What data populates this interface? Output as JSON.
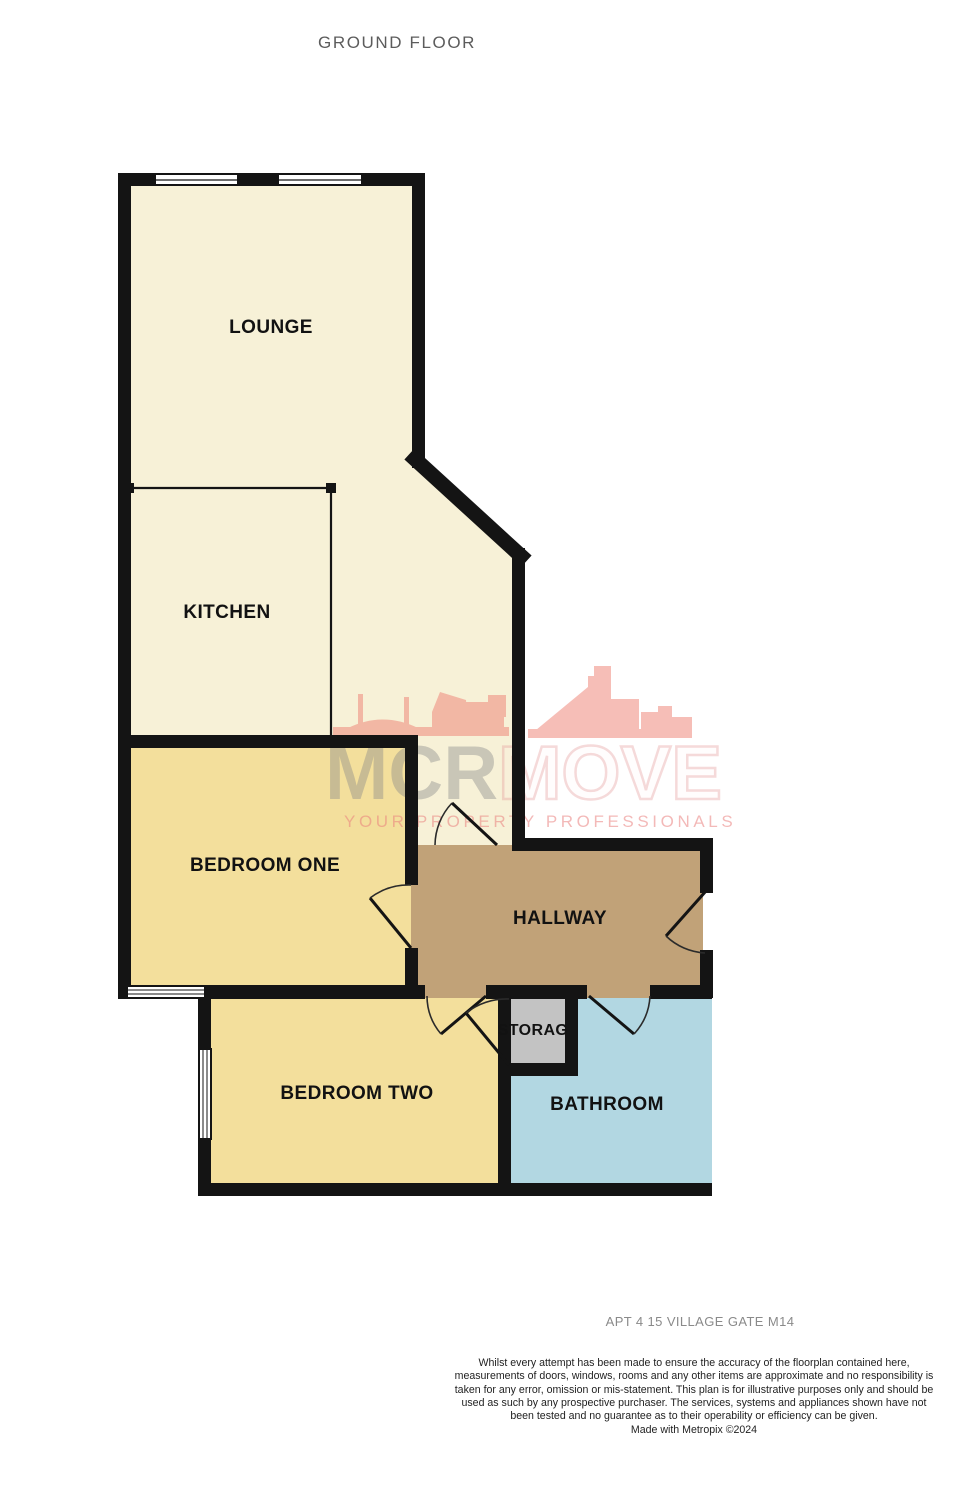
{
  "title": "GROUND FLOOR",
  "rooms": {
    "lounge": {
      "label": "LOUNGE"
    },
    "kitchen": {
      "label": "KITCHEN"
    },
    "bedroom_one": {
      "label": "BEDROOM ONE"
    },
    "hallway": {
      "label": "HALLWAY"
    },
    "bedroom_two": {
      "label": "BEDROOM TWO"
    },
    "storage": {
      "label": "STORAG"
    },
    "bathroom": {
      "label": "BATHROOM"
    }
  },
  "watermark": {
    "brand_primary": "MCR",
    "brand_secondary": "MOVE",
    "tagline": "YOUR PROPERTY PROFESSIONALS",
    "skyline_icon": "manchester-skyline-icon"
  },
  "footer": {
    "address": "APT 4 15 VILLAGE GATE M14",
    "disclaimer": "Whilst every attempt has been made to ensure the accuracy of the floorplan contained here, measurements of doors, windows, rooms and any other items are approximate and no responsibility is taken for any error, omission or mis-statement. This plan is for illustrative purposes only and should be used as such by any prospective purchaser. The services, systems and appliances shown have not been tested and no guarantee as to their operability or efficiency can be given.",
    "credit": "Made with Metropix ©2024"
  },
  "colors": {
    "floor-cream": "#f7f1d7",
    "floor-yellow": "#f3df9c",
    "floor-brown": "#c1a278",
    "floor-gray": "#c3c3c3",
    "floor-blue": "#b2d7e2",
    "wall": "#141414",
    "door-arc": "#2b2b2b",
    "title-gray": "#5c5c5c",
    "address-gray": "#8a8a8a",
    "disclaimer": "#1f1f1f",
    "watermark-red": "#ee7f72"
  }
}
